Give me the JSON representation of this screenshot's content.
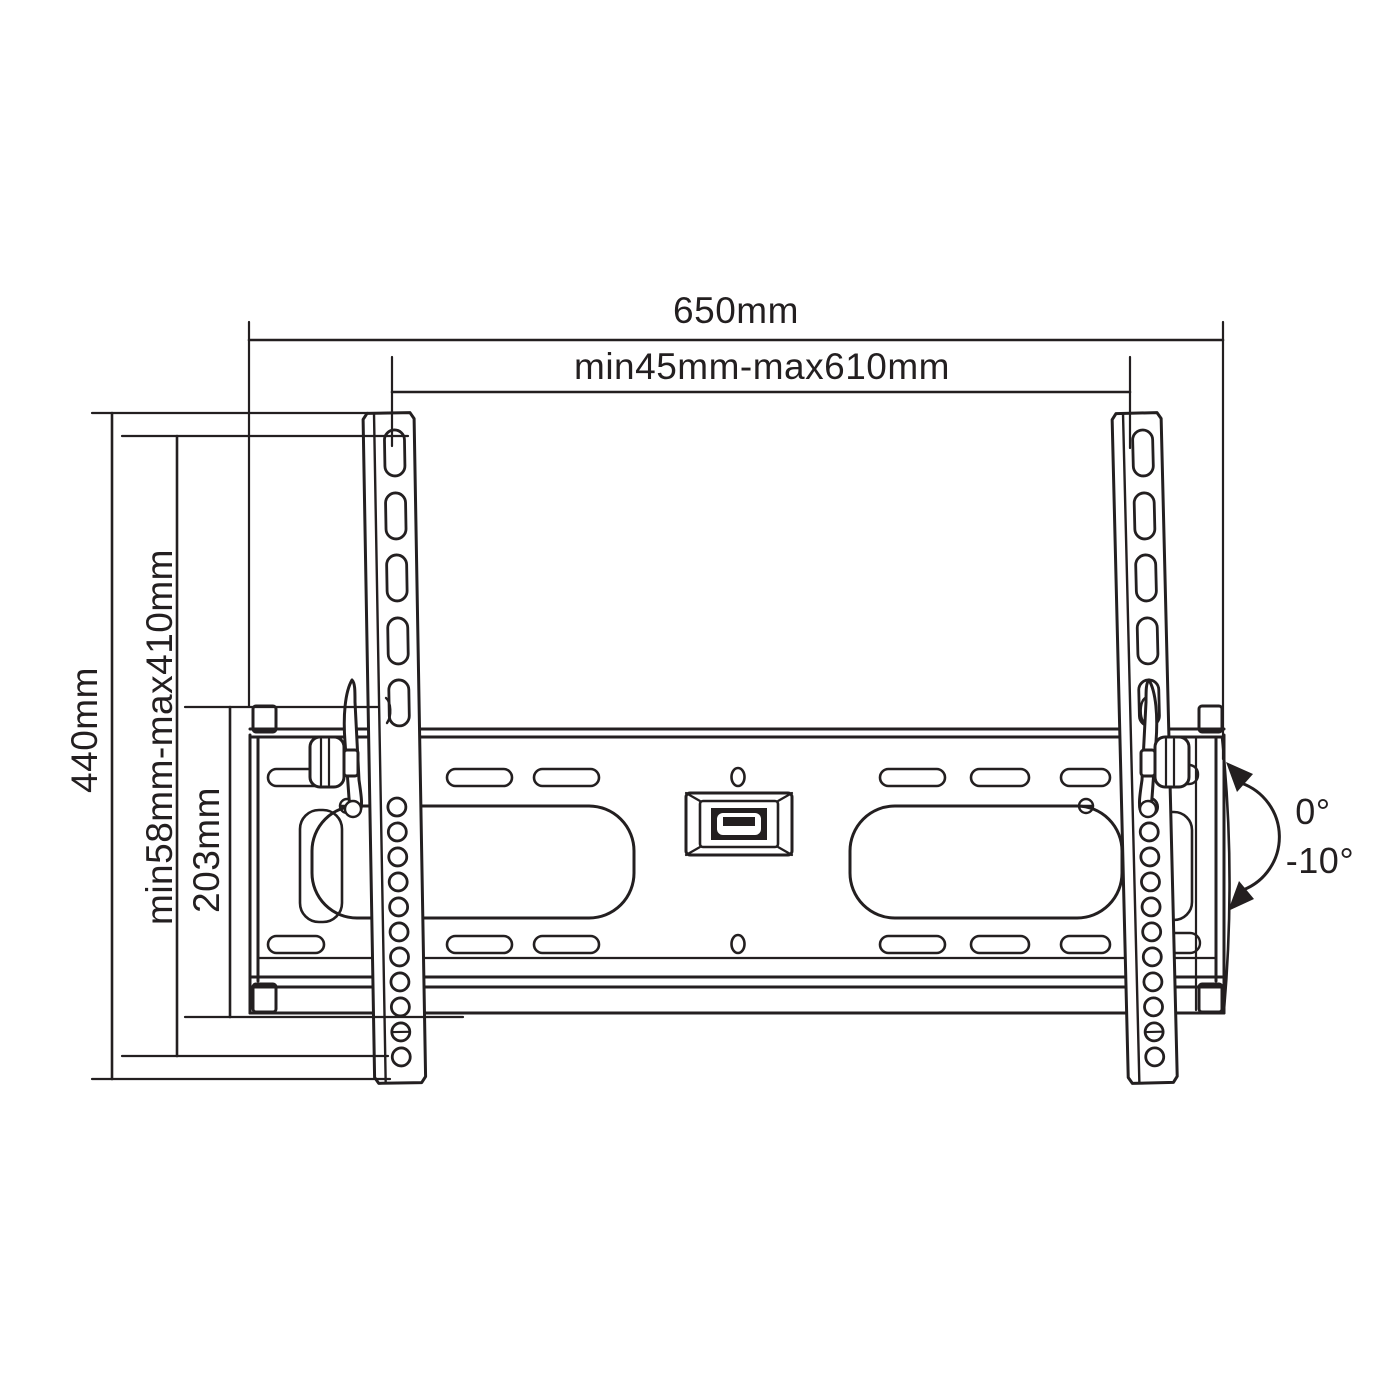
{
  "drawing": {
    "type": "technical-diagram",
    "subject": "Tilting TV wall-mount bracket, front view with dimension callouts",
    "dimensions": {
      "overall_width": "650mm",
      "mount_width_range": "min45mm-max610mm",
      "overall_height": "440mm",
      "mount_height_range": "min58mm-max410mm",
      "plate_height": "203mm"
    },
    "tilt": {
      "max_label": "0°",
      "min_label": "-10°"
    },
    "colors": {
      "line": "#231f20",
      "background": "#ffffff"
    }
  }
}
